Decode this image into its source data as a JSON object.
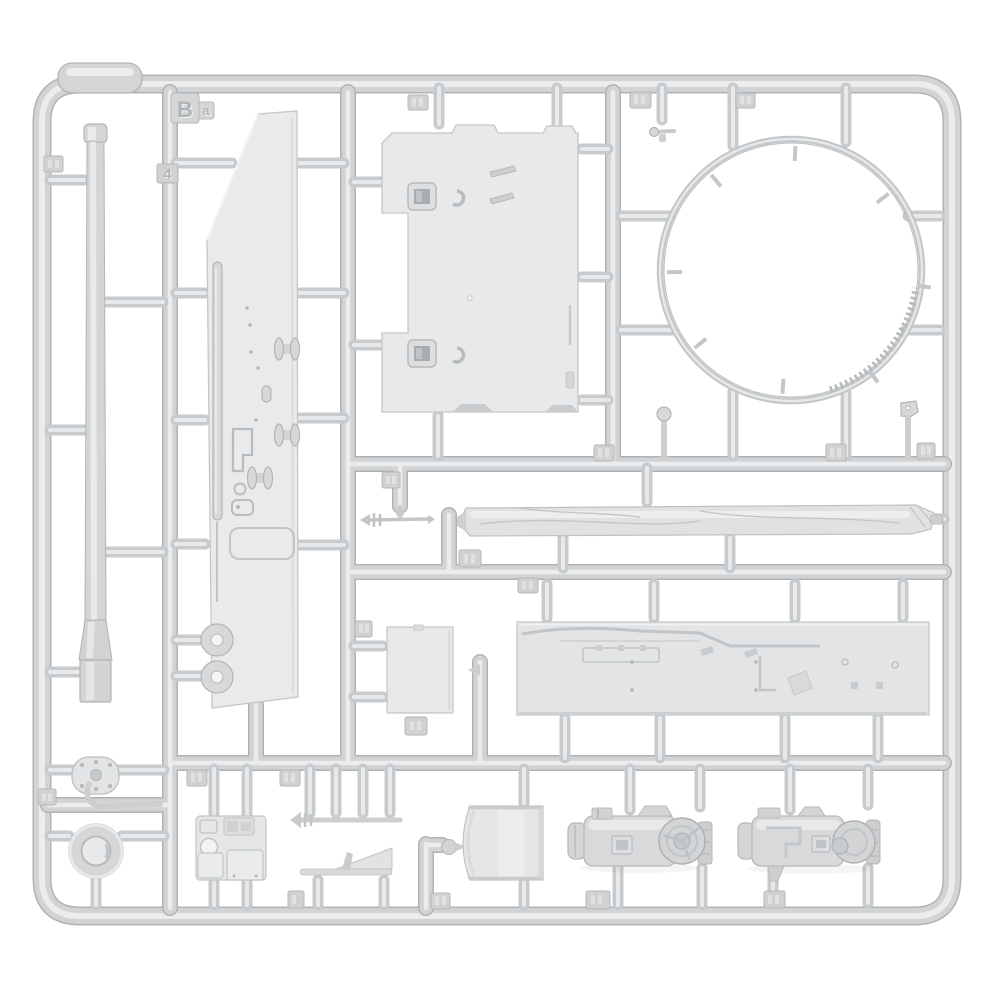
{
  "scene": {
    "description": "Light-grey injection moulded model kit sprue (runner frame) with tank model parts, photographed on a white background",
    "background": "#ffffff"
  },
  "colors": {
    "plastic_base": "#d1d3d5",
    "plastic_highlight": "#ebeced",
    "plastic_edge": "#b0b3b5",
    "part_plate": "#e8eaeb",
    "tag_chip": "#cfd1d3"
  },
  "sprue": {
    "letter": "B",
    "letter_suffix": "a",
    "visible_part_number": "4"
  },
  "parts": [
    "gun-barrel",
    "hull-side-plate",
    "hull-roof-plate",
    "turret-ring",
    "rolled-tarpaulin",
    "long-fender-plate",
    "small-rectangular-plate",
    "round-access-cover",
    "towing-hook",
    "wheel-hub",
    "engine-deck-plate",
    "cleaning-rod",
    "splash-guard-wedge",
    "curved-panel",
    "engine-cylinder-left",
    "engine-cylinder-right",
    "small-fittings"
  ]
}
